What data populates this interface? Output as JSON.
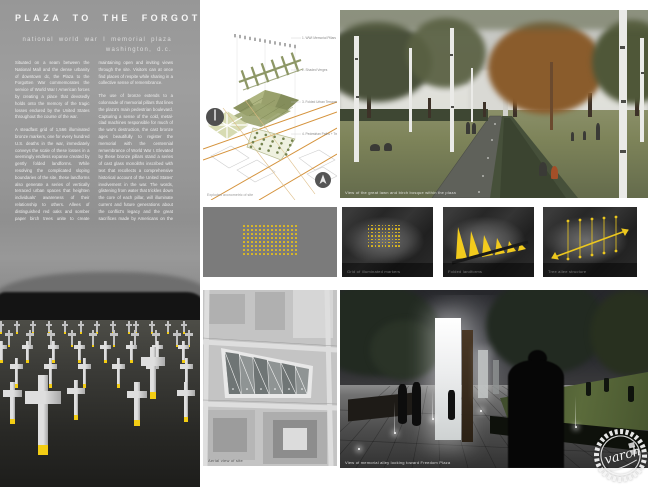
{
  "header": {
    "title": "PLAZA TO THE FORGOTTEN WAR",
    "subtitle_line1": "national world war I memorial plaza",
    "subtitle_line2": "washington, d.c."
  },
  "narrative": {
    "col1": [
      "Situated on a seam between the National Mall and the dense urbanity of downtown dc, the Plaza to the Forgotten War commemorates the service of World War I American forces by creating a place that devotedly holds onto the memory of the tragic losses endured by the United States throughout the course of the war.",
      "A steadfast grid of 1,566 illuminated bronze markers, one for every hundred U.S. deaths in the war, immediately conveys the scale of these losses in a seemingly endless expanse created by gently folded landforms. While resolving the complicated sloping boundaries of the site, these landforms also generate a series of vertically terraced urban spaces that heighten individuals' awareness of their relationship to others. Allees of distinguished red oaks and somber paper birch trees unite to create textured spatial definitions buffering the plaza from the noise of the surrounding environment while"
    ],
    "col2": [
      "maintaining open and inviting views through the site. Visitors can at once find places of respite while sharing in a collective sense of remembrance.",
      "The use of bronze extends to a colonnade of memorial pillars that lines the plaza's main pedestrian boulevard. Capturing a sense of the cold, metal-clad machines responsible for much of the war's destruction, the cast bronze ages beautifully to register the memorial with the centennial remembrance of World War I. Elevated by these bronze pillars stand a series of cast glass monoliths inscribed with text that recollects a comprehensive historical account of the United States' involvement in the war. The words, glistening from water that trickles down the core of each pillar, will illuminate current and future generations about the conflict's legacy and the great sacrifices made by Americans on the battlefields and at home."
    ]
  },
  "axon": {
    "labels": [
      "1. WWI Memorial Pillars",
      "2. Shaded Verges",
      "3. Folded Urban Terraces",
      "4. Pedestrian Paths + Trees"
    ],
    "caption": "Exploded axonometric of site"
  },
  "plaza_render": {
    "caption": "View of the great lawn and birch bosque within the plaza"
  },
  "concept_panels": {
    "grid": {
      "cols": 14,
      "rows": 8
    },
    "overlay_grid": {
      "cols": 10,
      "rows": 7
    },
    "captions": [
      "Grid of illuminated markers",
      "Folded landforms",
      "Tree allee structure"
    ]
  },
  "site_aerial": {
    "caption": "Aerial view of site"
  },
  "night_render": {
    "caption": "View of memorial alley looking toward Freedom Plaza"
  },
  "watermark": {
    "text": "varch"
  },
  "colors": {
    "accent_yellow": "#f3cd14",
    "olive": "#8d9766",
    "road_orange": "#d5933c"
  }
}
